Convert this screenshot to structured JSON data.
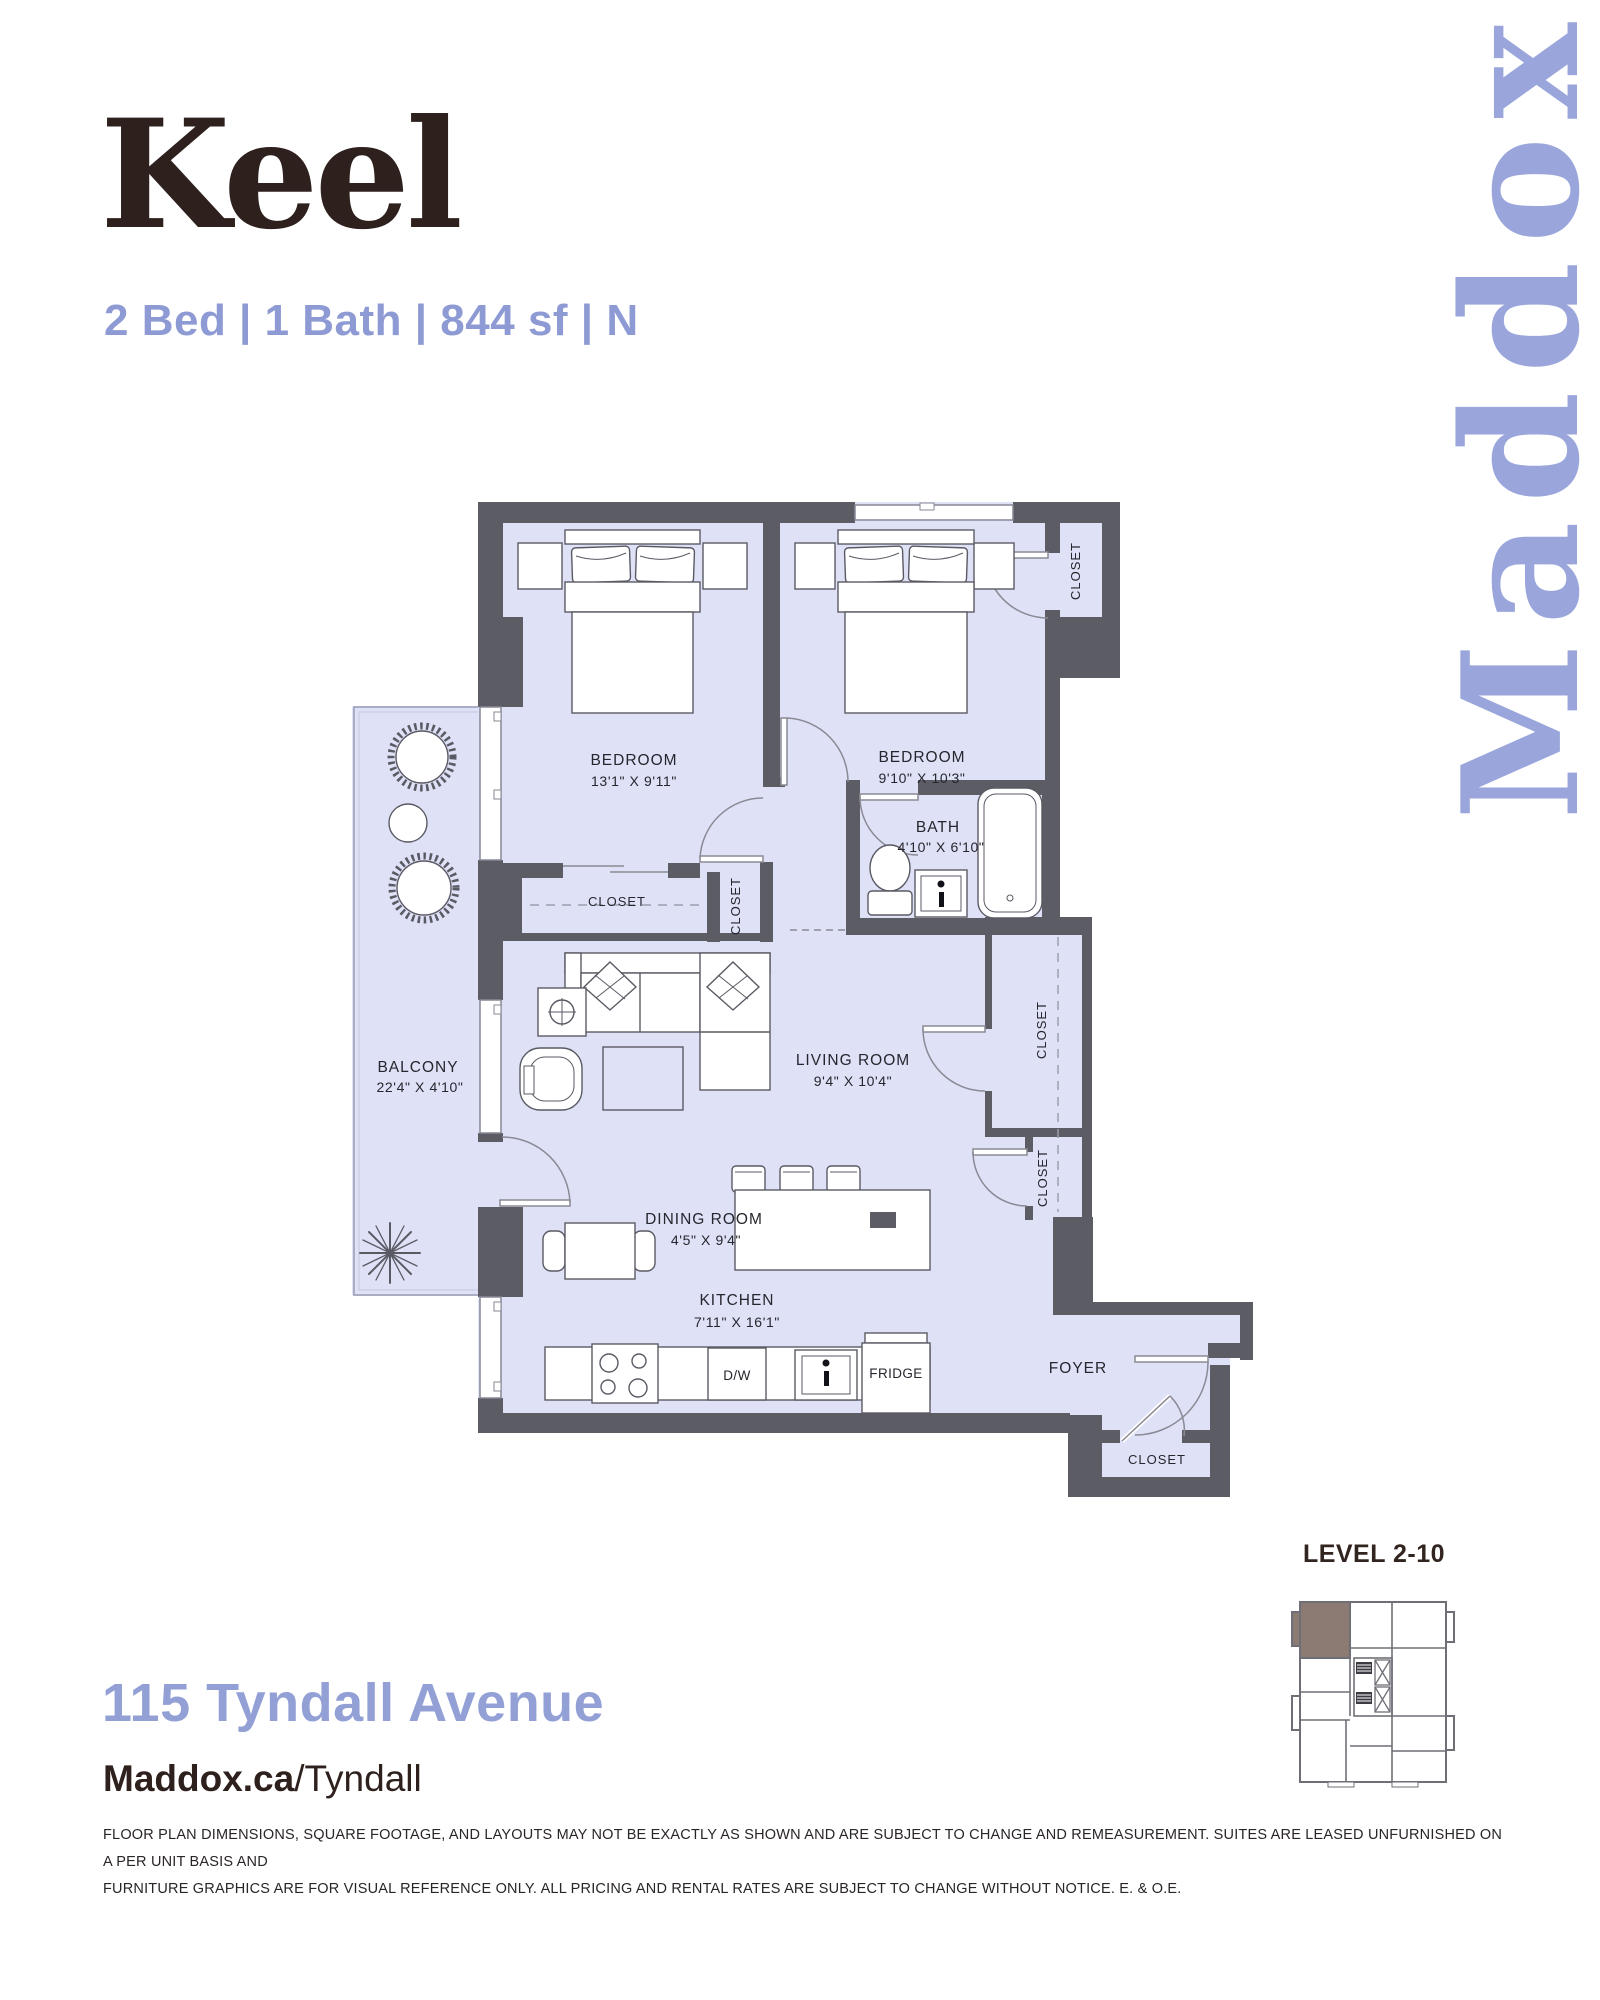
{
  "page": {
    "title": "Keel",
    "subtitle": "2 Bed | 1 Bath | 844 sf | N",
    "watermark": "Maddox"
  },
  "floorplan": {
    "closet_label": "CLOSET",
    "appliances": {
      "dishwasher": "D/W",
      "fridge": "FRIDGE"
    },
    "rooms": [
      {
        "id": "bedroom-1",
        "name": "BEDROOM",
        "dims": "13'1\" X 9'11\""
      },
      {
        "id": "bedroom-2",
        "name": "BEDROOM",
        "dims": "9'10\" X 10'3\""
      },
      {
        "id": "bath",
        "name": "BATH",
        "dims": "4'10\" X 6'10\""
      },
      {
        "id": "living-room",
        "name": "LIVING ROOM",
        "dims": "9'4\" X 10'4\""
      },
      {
        "id": "balcony",
        "name": "BALCONY",
        "dims": "22'4\" X 4'10\""
      },
      {
        "id": "dining-room",
        "name": "DINING ROOM",
        "dims": "4'5\" X 9'4\""
      },
      {
        "id": "kitchen",
        "name": "KITCHEN",
        "dims": "7'11\" X 16'1\""
      },
      {
        "id": "foyer",
        "name": "FOYER",
        "dims": ""
      }
    ]
  },
  "keyplan": {
    "label": "LEVEL 2-10"
  },
  "footer": {
    "address": "115 Tyndall Avenue",
    "website_bold": "Maddox.ca",
    "website_path": "/Tyndall",
    "disclaimer_line1": "FLOOR PLAN DIMENSIONS, SQUARE FOOTAGE, AND LAYOUTS MAY NOT BE EXACTLY AS SHOWN AND ARE SUBJECT TO CHANGE AND REMEASUREMENT. SUITES ARE LEASED UNFURNISHED ON A PER UNIT BASIS AND",
    "disclaimer_line2": "FURNITURE GRAPHICS ARE FOR VISUAL REFERENCE ONLY. ALL PRICING AND RENTAL RATES ARE SUBJECT TO CHANGE WITHOUT NOTICE. E. & O.E."
  },
  "colors": {
    "ink_brown": "#2e201d",
    "accent_periwinkle": "#8e9ad3",
    "watermark_periwinkle": "#9aa6db",
    "wall_gray": "#5c5c64",
    "floor_lavender": "#dfe2f7",
    "keyplan_highlight": "#8c7b72"
  }
}
